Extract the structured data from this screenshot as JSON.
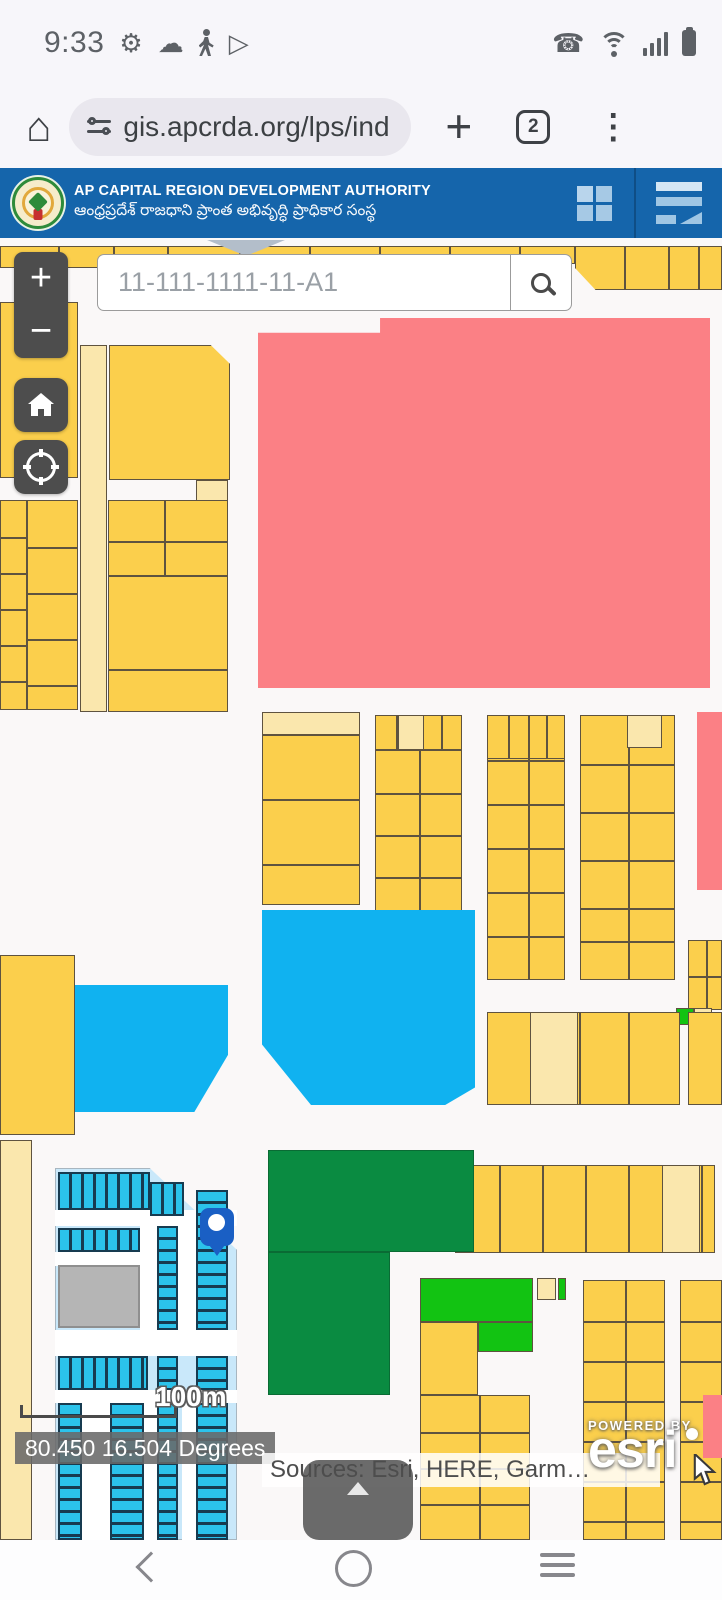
{
  "status_bar": {
    "time": "9:33"
  },
  "browser": {
    "url": "gis.apcrda.org/lps/ind",
    "tab_count": "2"
  },
  "header": {
    "title": "AP CAPITAL REGION DEVELOPMENT AUTHORITY",
    "subtitle": "ఆంధ్రప్రదేశ్ రాజధాని ప్రాంత అభివృద్ధి ప్రాధికార సంస్థ"
  },
  "search": {
    "placeholder": "11-111-1111-11-A1"
  },
  "map": {
    "controls": {
      "zoom_in": "+",
      "zoom_out": "−"
    },
    "scale_label": "100m",
    "coordinates": "80.450 16.504 Degrees",
    "attribution": "Sources: Esri, HERE, Garm…",
    "esri": {
      "powered_by": "POWERED BY",
      "brand": "esri"
    },
    "palette": {
      "hblue": "#1565AB",
      "yellow": "#FBCF4C",
      "cream": "#FAE7AD",
      "outline": "#5E5340",
      "red": "#FB8085",
      "blue": "#10B2F0",
      "dgreen": "#0A8B41",
      "bgreen": "#12C312",
      "pblue": "#C9E8FA",
      "cyan": "#2BC3EB",
      "cyanline": "#173B50",
      "gray": "#B5B5B5",
      "road": "#FFFFFF",
      "triangle": "#B3BECA",
      "mapbg": "#FAF8F8",
      "pin": "#1A5FC4",
      "btn": "#4D4D4D",
      "statusicon": "#5D6166",
      "pilltext": "#3C4043",
      "pillbg": "#E9E7EE"
    },
    "parcels": [
      {
        "x": 0,
        "y": 8,
        "w": 168,
        "h": 22,
        "f": "y",
        "vd": [
          57,
          112
        ]
      },
      {
        "x": 168,
        "y": 8,
        "w": 407,
        "h": 18,
        "f": "y",
        "vd": [
          70,
          140,
          210,
          280,
          350
        ]
      },
      {
        "x": 575,
        "y": 8,
        "w": 147,
        "h": 44,
        "f": "y",
        "vd": [
          48,
          92,
          122
        ],
        "c": "polygon(0 0,100% 0,100% 100%,14% 100%,0 50%)"
      },
      {
        "x": 207,
        "y": 2,
        "w": 78,
        "h": 16,
        "f": "gt",
        "c": "polygon(0 0,100% 0,50% 100%)"
      },
      {
        "x": 0,
        "y": 64,
        "w": 78,
        "h": 176,
        "f": "y"
      },
      {
        "x": 80,
        "y": 107,
        "w": 27,
        "h": 367,
        "f": "c"
      },
      {
        "x": 109,
        "y": 107,
        "w": 121,
        "h": 135,
        "f": "y",
        "c": "polygon(0 0,84% 0,100% 14%,100% 100%,0 100%)"
      },
      {
        "x": 196,
        "y": 242,
        "w": 32,
        "h": 24,
        "f": "c"
      },
      {
        "x": 0,
        "y": 262,
        "w": 27,
        "h": 210,
        "f": "y",
        "hd": [
          36,
          72,
          108,
          144,
          180
        ]
      },
      {
        "x": 27,
        "y": 262,
        "w": 51,
        "h": 210,
        "f": "y",
        "hd": [
          46,
          92,
          138,
          184
        ]
      },
      {
        "x": 108,
        "y": 262,
        "w": 120,
        "h": 76,
        "f": "y",
        "vd": [
          55
        ],
        "hd": [
          40
        ]
      },
      {
        "x": 108,
        "y": 338,
        "w": 120,
        "h": 136,
        "f": "y",
        "hd": [
          92
        ]
      },
      {
        "x": 262,
        "y": 474,
        "w": 98,
        "h": 23,
        "f": "c"
      },
      {
        "x": 262,
        "y": 497,
        "w": 98,
        "h": 170,
        "f": "y",
        "hd": [
          63,
          128
        ]
      },
      {
        "x": 375,
        "y": 477,
        "w": 87,
        "h": 35,
        "f": "y",
        "vd": [
          20,
          43,
          65
        ]
      },
      {
        "x": 398,
        "y": 477,
        "w": 26,
        "h": 35,
        "f": "c"
      },
      {
        "x": 375,
        "y": 512,
        "w": 87,
        "h": 170,
        "f": "y",
        "vd": [
          43
        ],
        "hd": [
          42,
          84,
          126
        ]
      },
      {
        "x": 258,
        "y": 80,
        "w": 452,
        "h": 370,
        "f": "r",
        "c": "polygon(0 4%,27% 4%,27% 0,100% 0,100% 100%,0 100%)"
      },
      {
        "x": 697,
        "y": 474,
        "w": 25,
        "h": 178,
        "f": "r"
      },
      {
        "x": 262,
        "y": 672,
        "w": 213,
        "h": 195,
        "f": "b",
        "c": "polygon(0 0,100% 0,100% 91%,86% 100%,23% 100%,0 69%)"
      },
      {
        "x": 75,
        "y": 747,
        "w": 153,
        "h": 127,
        "f": "b",
        "c": "polygon(0 0,100% 0,100% 55%,78% 100%,0 100%)"
      },
      {
        "x": 0,
        "y": 717,
        "w": 75,
        "h": 180,
        "f": "y"
      },
      {
        "x": 487,
        "y": 477,
        "w": 78,
        "h": 265,
        "f": "y",
        "vd": [
          40
        ],
        "hd": [
          44,
          88,
          132,
          176,
          220
        ]
      },
      {
        "x": 487,
        "y": 477,
        "w": 78,
        "h": 44,
        "f": "y",
        "vd": [
          20,
          40,
          58
        ]
      },
      {
        "x": 580,
        "y": 477,
        "w": 95,
        "h": 265,
        "f": "y",
        "vd": [
          47
        ],
        "hd": [
          48,
          96,
          144,
          192,
          225
        ]
      },
      {
        "x": 627,
        "y": 477,
        "w": 35,
        "h": 33,
        "f": "c"
      },
      {
        "x": 688,
        "y": 702,
        "w": 34,
        "h": 70,
        "f": "y",
        "vd": [
          17
        ],
        "hd": [
          35
        ]
      },
      {
        "x": 676,
        "y": 770,
        "w": 18,
        "h": 17,
        "f": "bg"
      },
      {
        "x": 694,
        "y": 770,
        "w": 18,
        "h": 17,
        "f": "c"
      },
      {
        "x": 487,
        "y": 774,
        "w": 193,
        "h": 93,
        "f": "y",
        "vd": [
          43,
          91,
          140
        ]
      },
      {
        "x": 530,
        "y": 774,
        "w": 48,
        "h": 93,
        "f": "c"
      },
      {
        "x": 688,
        "y": 774,
        "w": 34,
        "h": 93,
        "f": "y"
      },
      {
        "x": 455,
        "y": 927,
        "w": 260,
        "h": 88,
        "f": "y",
        "vd": [
          43,
          86,
          129,
          172,
          207,
          245
        ]
      },
      {
        "x": 662,
        "y": 927,
        "w": 38,
        "h": 88,
        "f": "c"
      },
      {
        "x": 268,
        "y": 912,
        "w": 206,
        "h": 102,
        "f": "dg"
      },
      {
        "x": 268,
        "y": 1014,
        "w": 122,
        "h": 143,
        "f": "dg"
      },
      {
        "x": 420,
        "y": 1040,
        "w": 113,
        "h": 44,
        "f": "bg"
      },
      {
        "x": 478,
        "y": 1084,
        "w": 55,
        "h": 30,
        "f": "bg"
      },
      {
        "x": 420,
        "y": 1084,
        "w": 58,
        "h": 73,
        "f": "y"
      },
      {
        "x": 537,
        "y": 1040,
        "w": 19,
        "h": 22,
        "f": "c"
      },
      {
        "x": 558,
        "y": 1040,
        "w": 8,
        "h": 22,
        "f": "bg"
      },
      {
        "x": 583,
        "y": 1042,
        "w": 82,
        "h": 260,
        "f": "y",
        "vd": [
          41
        ],
        "hd": [
          40,
          80,
          120,
          160,
          200,
          240
        ]
      },
      {
        "x": 680,
        "y": 1042,
        "w": 42,
        "h": 260,
        "f": "y",
        "hd": [
          40,
          80,
          120,
          160,
          200,
          240
        ]
      },
      {
        "x": 703,
        "y": 1157,
        "w": 19,
        "h": 63,
        "f": "r"
      },
      {
        "x": 420,
        "y": 1157,
        "w": 110,
        "h": 145,
        "f": "y",
        "vd": [
          58
        ],
        "hd": [
          36,
          72,
          108
        ]
      },
      {
        "x": 0,
        "y": 902,
        "w": 32,
        "h": 400,
        "f": "c"
      },
      {
        "x": 55,
        "y": 930,
        "w": 182,
        "h": 372,
        "f": "pb",
        "c": "polygon(0 0,52% 0,100% 22%,100% 100%,0 100%)"
      },
      {
        "x": 55,
        "y": 972,
        "w": 182,
        "h": 16,
        "f": "w"
      },
      {
        "x": 55,
        "y": 1014,
        "w": 85,
        "h": 14,
        "f": "w"
      },
      {
        "x": 140,
        "y": 988,
        "w": 17,
        "h": 104,
        "f": "w"
      },
      {
        "x": 178,
        "y": 988,
        "w": 18,
        "h": 104,
        "f": "w"
      },
      {
        "x": 55,
        "y": 1092,
        "w": 182,
        "h": 26,
        "f": "w"
      },
      {
        "x": 55,
        "y": 1152,
        "w": 182,
        "h": 13,
        "f": "w"
      },
      {
        "x": 82,
        "y": 1165,
        "w": 28,
        "h": 137,
        "f": "w"
      },
      {
        "x": 144,
        "y": 1165,
        "w": 14,
        "h": 137,
        "f": "w"
      },
      {
        "x": 182,
        "y": 1165,
        "w": 14,
        "h": 137,
        "f": "w"
      },
      {
        "x": 58,
        "y": 934,
        "w": 92,
        "h": 38,
        "f": "cv"
      },
      {
        "x": 150,
        "y": 944,
        "w": 34,
        "h": 34,
        "f": "cv"
      },
      {
        "x": 58,
        "y": 990,
        "w": 82,
        "h": 24,
        "f": "cv"
      },
      {
        "x": 58,
        "y": 1027,
        "w": 82,
        "h": 63,
        "f": "gr"
      },
      {
        "x": 157,
        "y": 988,
        "w": 21,
        "h": 104,
        "f": "ch"
      },
      {
        "x": 196,
        "y": 952,
        "w": 32,
        "h": 140,
        "f": "ch"
      },
      {
        "x": 58,
        "y": 1118,
        "w": 90,
        "h": 34,
        "f": "cv"
      },
      {
        "x": 157,
        "y": 1118,
        "w": 21,
        "h": 34,
        "f": "ch"
      },
      {
        "x": 196,
        "y": 1118,
        "w": 32,
        "h": 34,
        "f": "ch"
      },
      {
        "x": 157,
        "y": 1165,
        "w": 21,
        "h": 137,
        "f": "ch"
      },
      {
        "x": 196,
        "y": 1165,
        "w": 32,
        "h": 137,
        "f": "ch"
      },
      {
        "x": 58,
        "y": 1165,
        "w": 24,
        "h": 137,
        "f": "ch"
      },
      {
        "x": 110,
        "y": 1165,
        "w": 34,
        "h": 137,
        "f": "ch"
      }
    ]
  }
}
